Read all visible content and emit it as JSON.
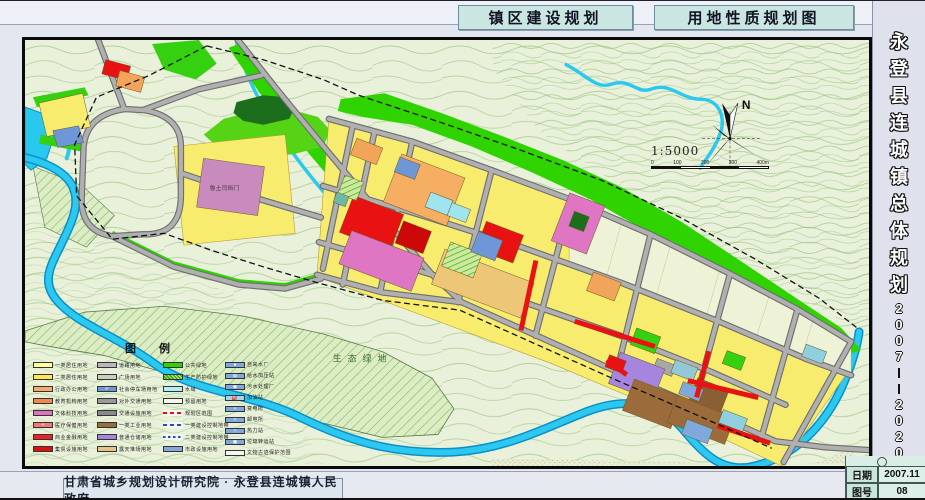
{
  "header": {
    "title_left": "镇区建设规划",
    "title_right": "用地性质规划图"
  },
  "sidebar": {
    "title": "永登县连城镇总体规划",
    "chars": [
      "永",
      "登",
      "县",
      "连",
      "城",
      "镇",
      "总",
      "体",
      "规",
      "划"
    ],
    "years": [
      "2",
      "0",
      "0",
      "7",
      "—",
      "—",
      "2",
      "0",
      "2",
      "0"
    ]
  },
  "footer": {
    "credit": "甘肃省城乡规划设计研究院 · 永登县连城镇人民政府",
    "date_label": "日期",
    "date_value": "2007.11",
    "sheet_label": "图号",
    "sheet_value": "08"
  },
  "map": {
    "north": "N",
    "scale": "1:5000",
    "scale_ticks": [
      "0",
      "100",
      "200",
      "300",
      "400m"
    ],
    "labels": {
      "eco_green": "生态绿地",
      "heritage": "鲁土司衙门"
    }
  },
  "legend": {
    "title": "图  例",
    "columns": [
      [
        {
          "label": "一类居住用地",
          "color": "#ffff9e",
          "kind": "fill"
        },
        {
          "label": "二类居住用地",
          "color": "#ffe94e",
          "kind": "fill"
        },
        {
          "label": "行政办公用地",
          "color": "#f6a96c",
          "kind": "fill"
        },
        {
          "label": "教育机构用地",
          "color": "#f08a4b",
          "kind": "fill"
        },
        {
          "label": "文体科技用地",
          "color": "#e070c0",
          "kind": "fill"
        },
        {
          "label": "医疗保健用地",
          "color": "#f07878",
          "kind": "fill",
          "symbol": "+"
        },
        {
          "label": "商业金融用地",
          "color": "#ee2222",
          "kind": "fill"
        },
        {
          "label": "集贸设施用地",
          "color": "#dd1111",
          "kind": "fill"
        }
      ],
      [
        {
          "label": "道路用地",
          "color": "#b8b8b8",
          "kind": "fill"
        },
        {
          "label": "广场用地",
          "color": "#c8cfc0",
          "kind": "fill"
        },
        {
          "label": "社会停车场用地",
          "color": "#6f96d6",
          "kind": "fill",
          "symbol": "P"
        },
        {
          "label": "对外交通用地",
          "color": "#9a9a9a",
          "kind": "fill"
        },
        {
          "label": "交通设施用地",
          "color": "#8a8a8a",
          "kind": "fill"
        },
        {
          "label": "一类工业用地",
          "color": "#9b6b3b",
          "kind": "fill"
        },
        {
          "label": "普通仓储用地",
          "color": "#a585dd",
          "kind": "fill"
        },
        {
          "label": "露天堆场用地",
          "color": "#e5c285",
          "kind": "fill"
        }
      ],
      [
        {
          "label": "公共绿地",
          "color": "#2ed300",
          "kind": "fill"
        },
        {
          "label": "生产防护绿地",
          "color": "#49b32c",
          "kind": "hatch"
        },
        {
          "label": "水域",
          "color": "#aef0f8",
          "kind": "fill"
        },
        {
          "label": "预留用地",
          "color": "#f4f8ec",
          "kind": "outline"
        },
        {
          "label": "规划区范围",
          "color": "#e01010",
          "kind": "line-red-dash"
        },
        {
          "label": "一类建设控制地带",
          "color": "#1a50c8",
          "kind": "line-blue-dash"
        },
        {
          "label": "二类建设控制地带",
          "color": "#1a50c8",
          "kind": "line-blue-dash2"
        },
        {
          "label": "市政设施用地",
          "color": "#87a7d8",
          "kind": "fill"
        }
      ],
      [
        {
          "label": "自来水厂",
          "color": "#7fa8dc",
          "kind": "fill",
          "symbol": "●"
        },
        {
          "label": "给水加压站",
          "color": "#7fa8dc",
          "kind": "fill",
          "symbol": "◍"
        },
        {
          "label": "污水处理厂",
          "color": "#7fa8dc",
          "kind": "fill",
          "symbol": "◉"
        },
        {
          "label": "加油站",
          "color": "#9fd8e8",
          "kind": "fill",
          "symbol": "⛽"
        },
        {
          "label": "变电所",
          "color": "#7fa8dc",
          "kind": "fill",
          "symbol": "⚡"
        },
        {
          "label": "邮电所",
          "color": "#7fa8dc",
          "kind": "fill",
          "symbol": "〒"
        },
        {
          "label": "热力站",
          "color": "#7fa8dc",
          "kind": "fill",
          "symbol": "≈"
        },
        {
          "label": "垃圾转运站",
          "color": "#7fa8dc",
          "kind": "fill",
          "symbol": "▣"
        },
        {
          "label": "文物古迹保护范围",
          "color": "#cccccc",
          "kind": "outline",
          "symbol": "╱"
        }
      ]
    ]
  }
}
